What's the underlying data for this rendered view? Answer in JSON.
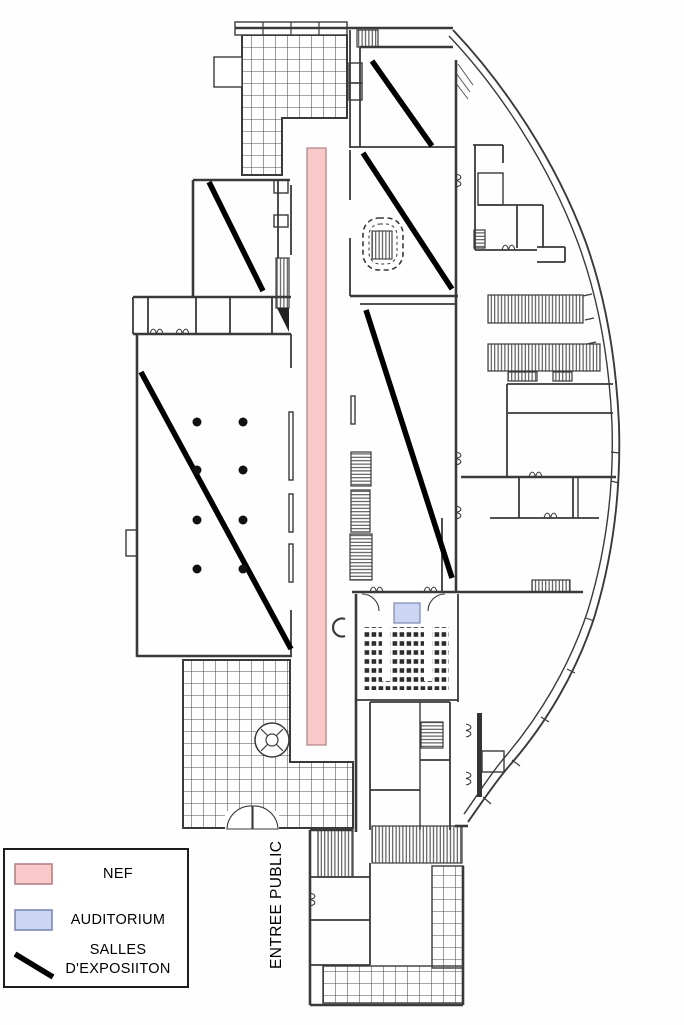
{
  "colors": {
    "nef_fill": "#f9c9ca",
    "nef_border": "#b08387",
    "auditorium_fill": "#ccd6f2",
    "auditorium_border": "#7d88b4",
    "exhibition_line": "#000000"
  },
  "legend": {
    "nef_label": "NEF",
    "auditorium_label": "AUDITORIUM",
    "exhibition_label_line1": "SALLES",
    "exhibition_label_line2": "D'EXPOSIITON"
  },
  "labels": {
    "public_entrance": "ENTREE PUBLIC"
  }
}
